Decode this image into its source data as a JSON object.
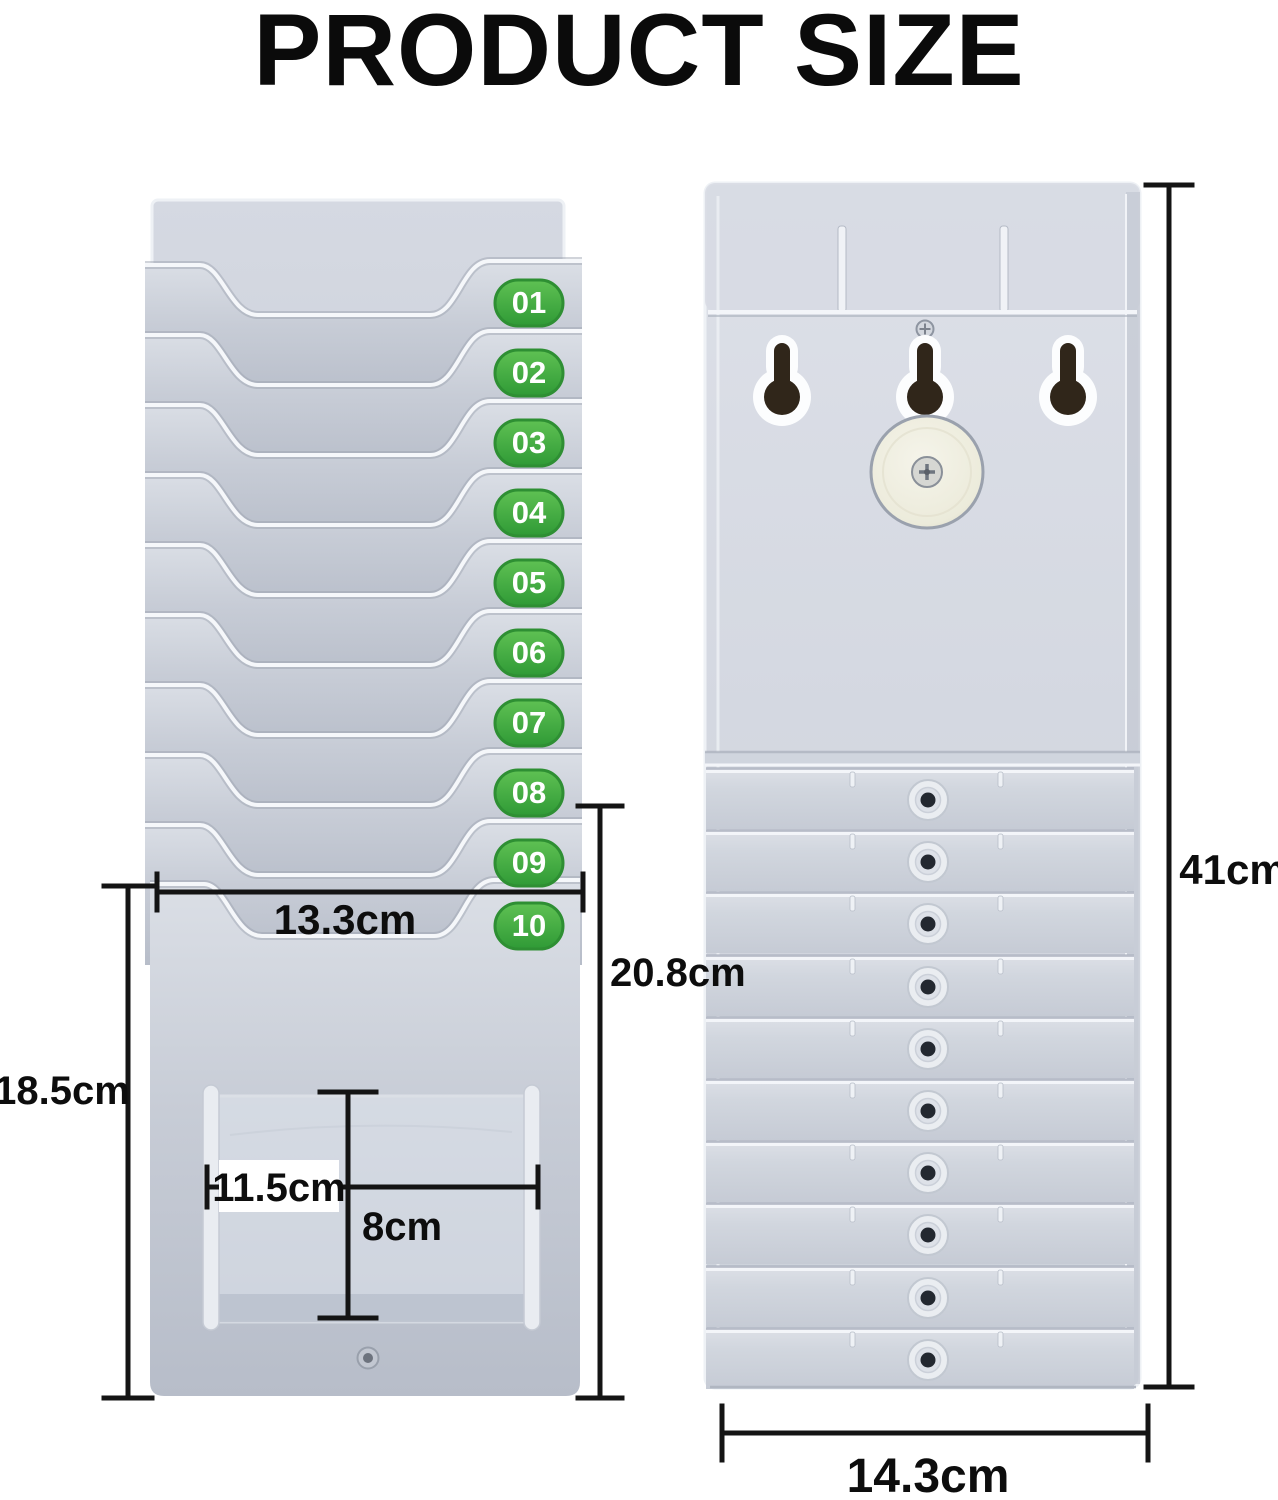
{
  "title": "PRODUCT SIZE",
  "colors": {
    "badge_green": "#3fae3f",
    "rack_gray": "#c9ced9",
    "dimension_line": "#141414"
  },
  "front_view": {
    "slots": [
      {
        "label": "01"
      },
      {
        "label": "02"
      },
      {
        "label": "03"
      },
      {
        "label": "04"
      },
      {
        "label": "05"
      },
      {
        "label": "06"
      },
      {
        "label": "07"
      },
      {
        "label": "08"
      },
      {
        "label": "09"
      },
      {
        "label": "10"
      }
    ]
  },
  "dimensions": {
    "slot_width": {
      "label": "13.3cm"
    },
    "front_lower_height": {
      "label": "18.5cm"
    },
    "pocket_section_height": {
      "label": "20.8cm"
    },
    "pocket_width": {
      "label": "11.5cm"
    },
    "pocket_height": {
      "label": "8cm"
    },
    "total_height": {
      "label": "41cm"
    },
    "back_width": {
      "label": "14.3cm"
    }
  }
}
